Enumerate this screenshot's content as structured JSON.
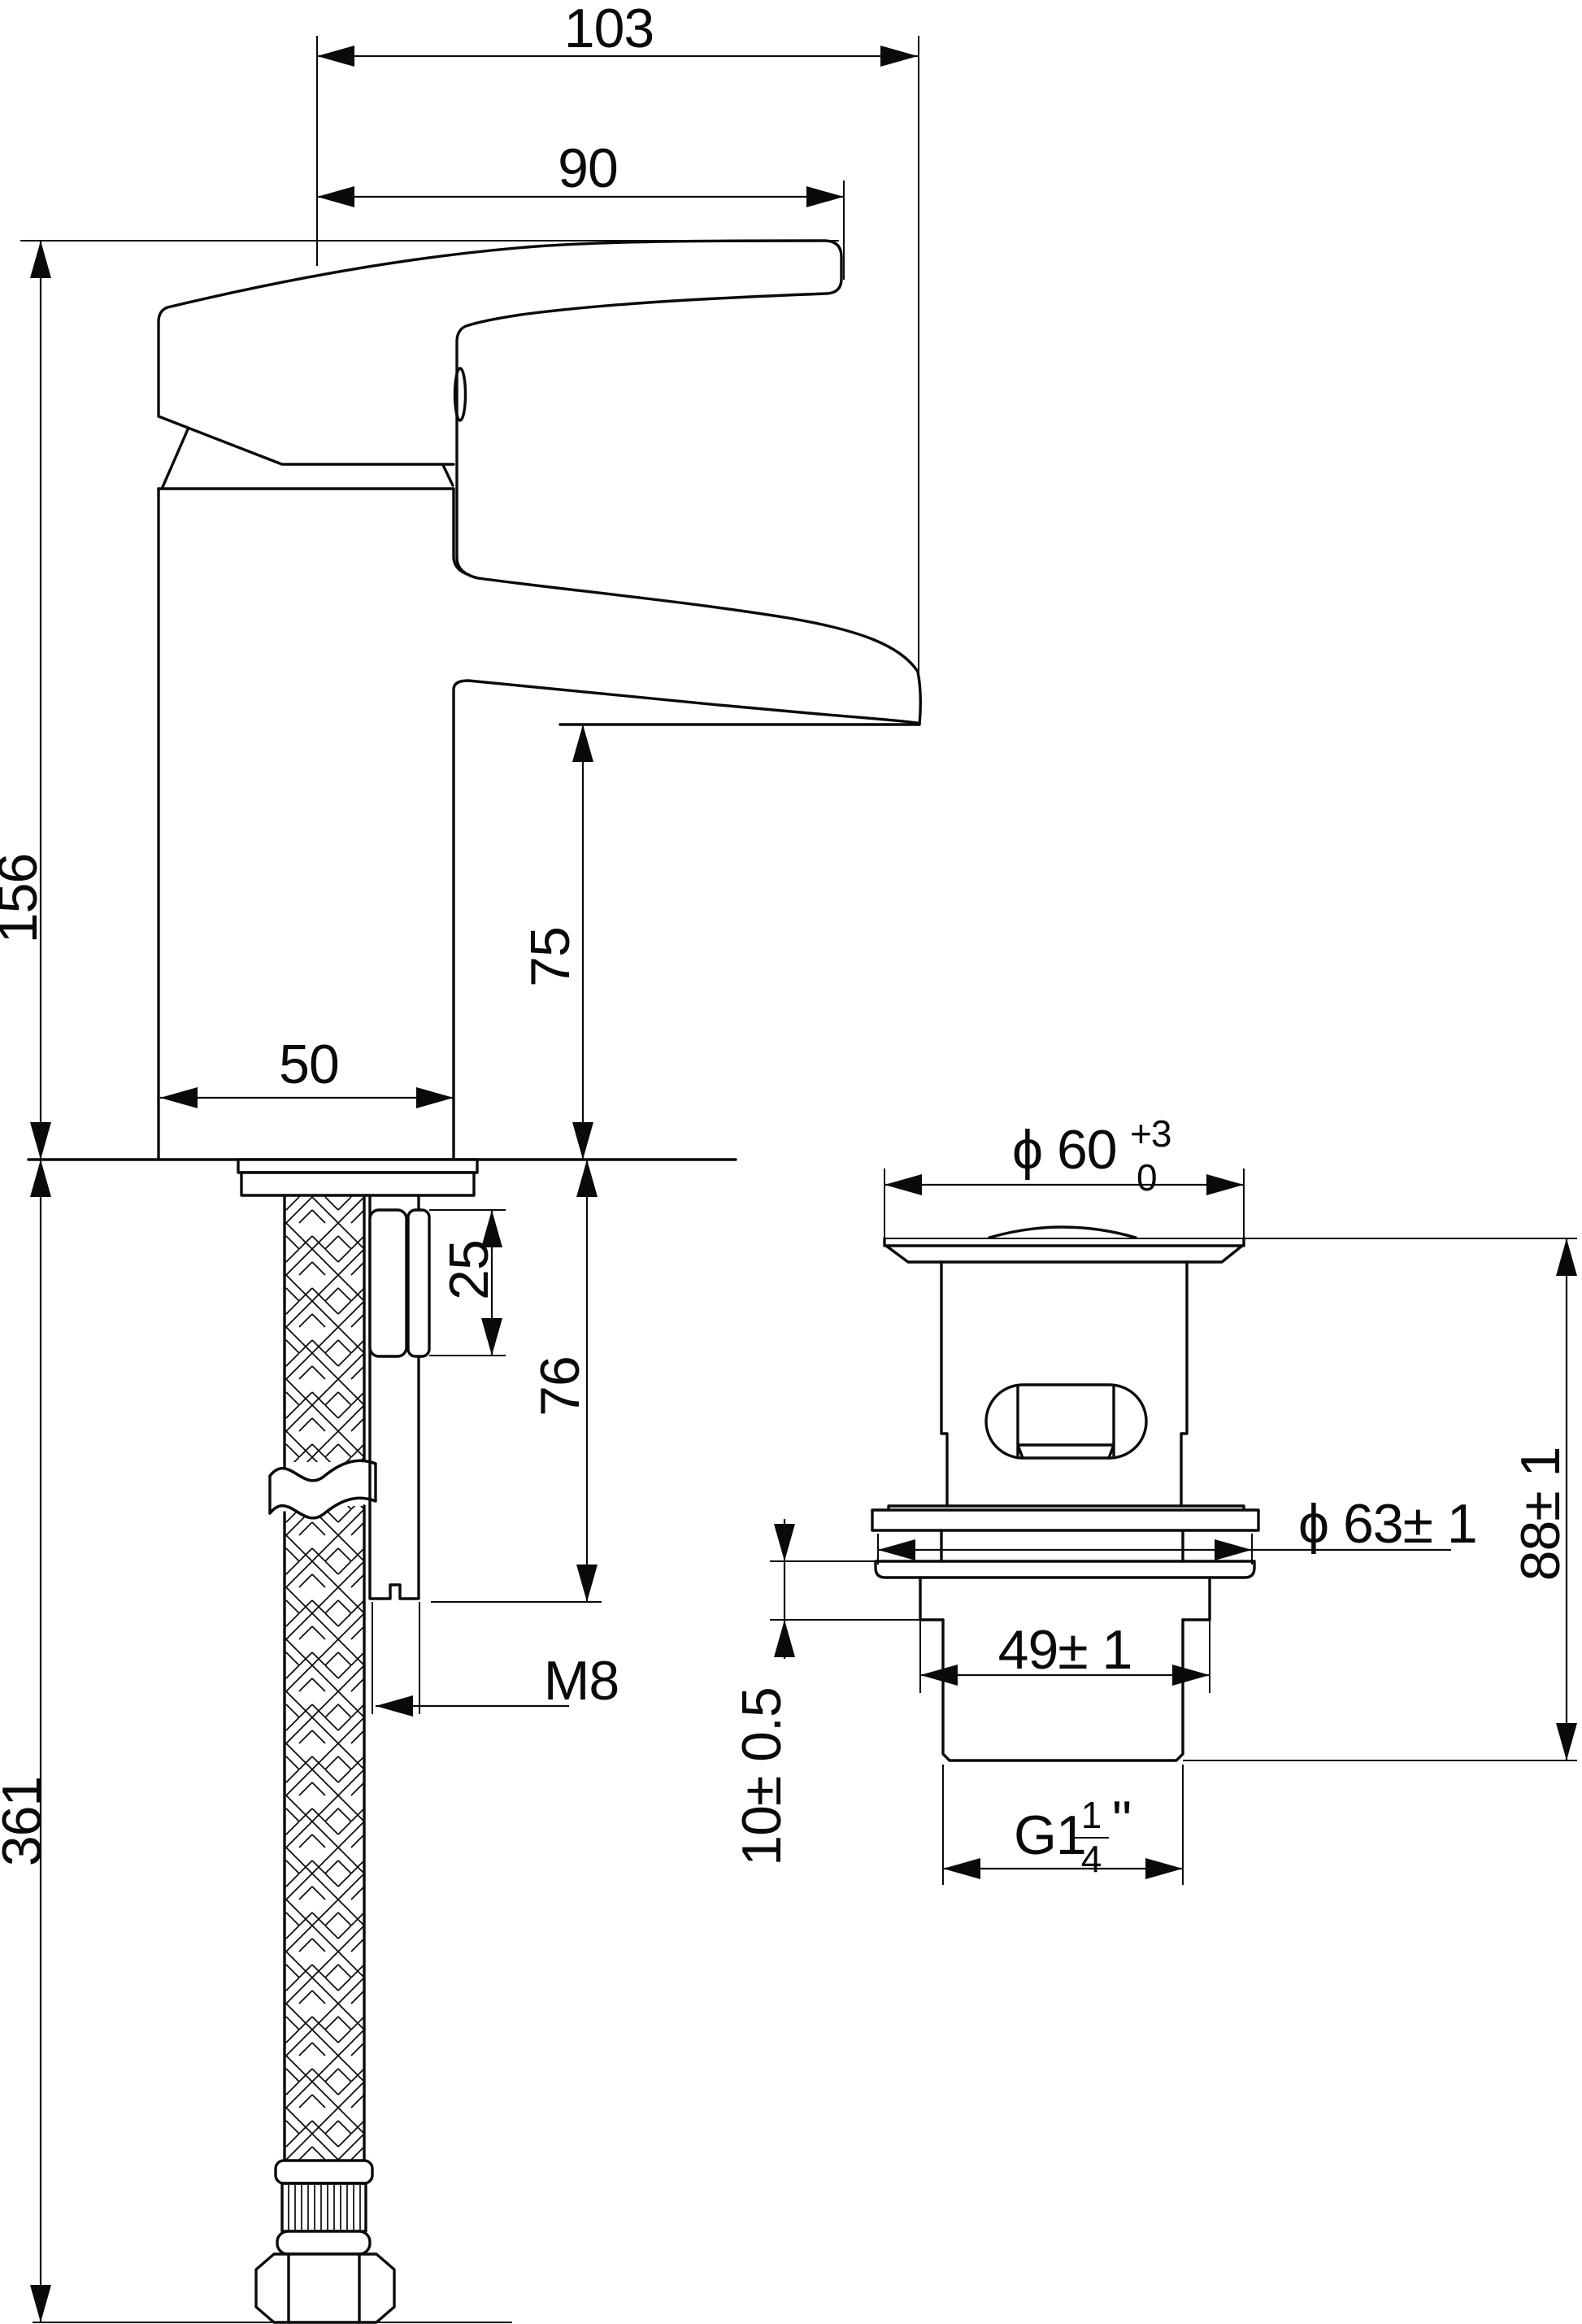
{
  "drawing": {
    "background": "#ffffff",
    "line_color": "#0a0a0a",
    "views": {
      "faucet": {
        "dims": {
          "overall_reach": "103",
          "handle_reach": "90",
          "overall_height": "156",
          "spout_height": "75",
          "body_width": "50",
          "spacer_length": "25",
          "stud_length": "76",
          "stud_thread": "M8",
          "hose_length": "361"
        }
      },
      "waste": {
        "dims": {
          "cap_diameter": "ϕ 60",
          "cap_diameter_tol_upper": "+3",
          "cap_diameter_tol_lower": "0",
          "overall_height": "88± 1",
          "flange_diameter": "ϕ 63± 1",
          "shank_width": "49± 1",
          "clamp_depth": "10± 0.5",
          "thread_main": "G1",
          "thread_frac_num": "1",
          "thread_frac_den": "4",
          "thread_unit": "\""
        }
      }
    }
  }
}
